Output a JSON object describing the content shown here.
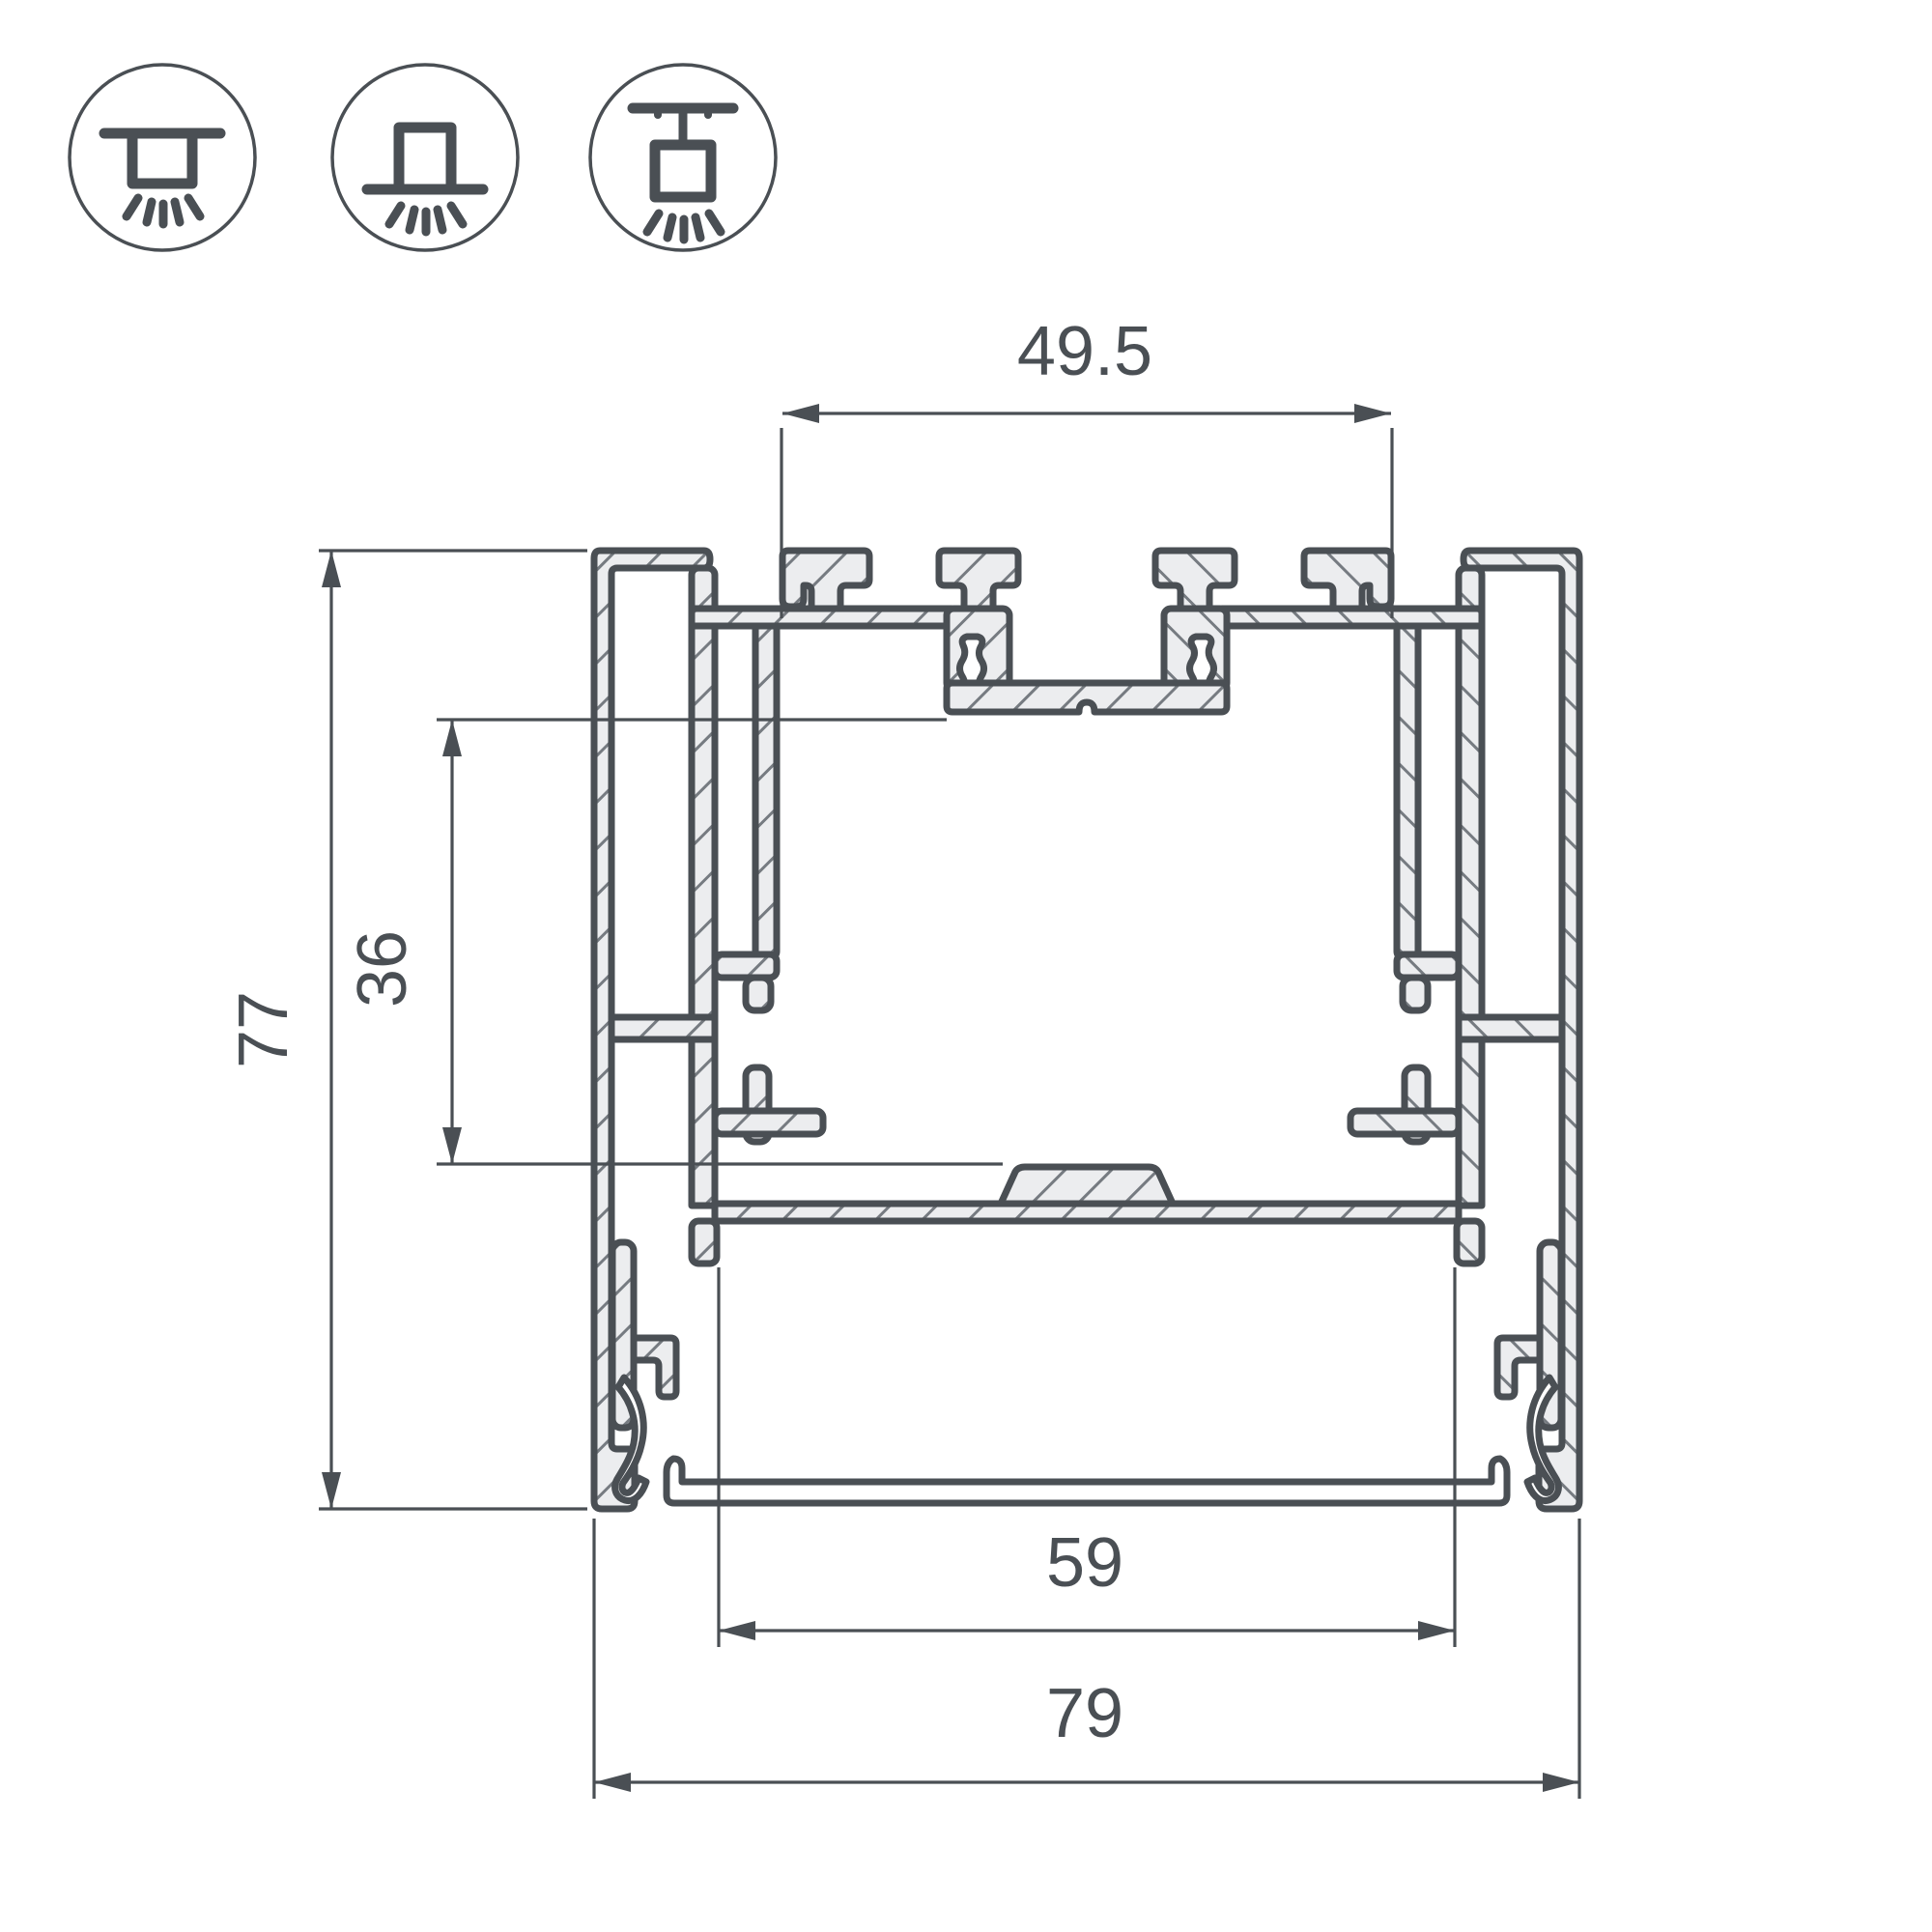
{
  "page": {
    "background": "#ffffff"
  },
  "icons": {
    "items": [
      {
        "name": "recessed-mount-icon",
        "meaning": "recessed ceiling mount"
      },
      {
        "name": "surface-mount-icon",
        "meaning": "surface ceiling mount"
      },
      {
        "name": "pendant-mount-icon",
        "meaning": "suspended pendant mount"
      }
    ]
  },
  "drawing": {
    "type": "aluminium profile cross-section",
    "dimensions": {
      "top_width": "49.5",
      "overall_height": "77",
      "upper_inner_height": "36",
      "bottom_opening_width": "59",
      "overall_width": "79"
    },
    "colors": {
      "outline": "#4a4f54",
      "hatch": "#767b81",
      "metal_fill": "#ecedef",
      "background": "#ffffff"
    }
  }
}
